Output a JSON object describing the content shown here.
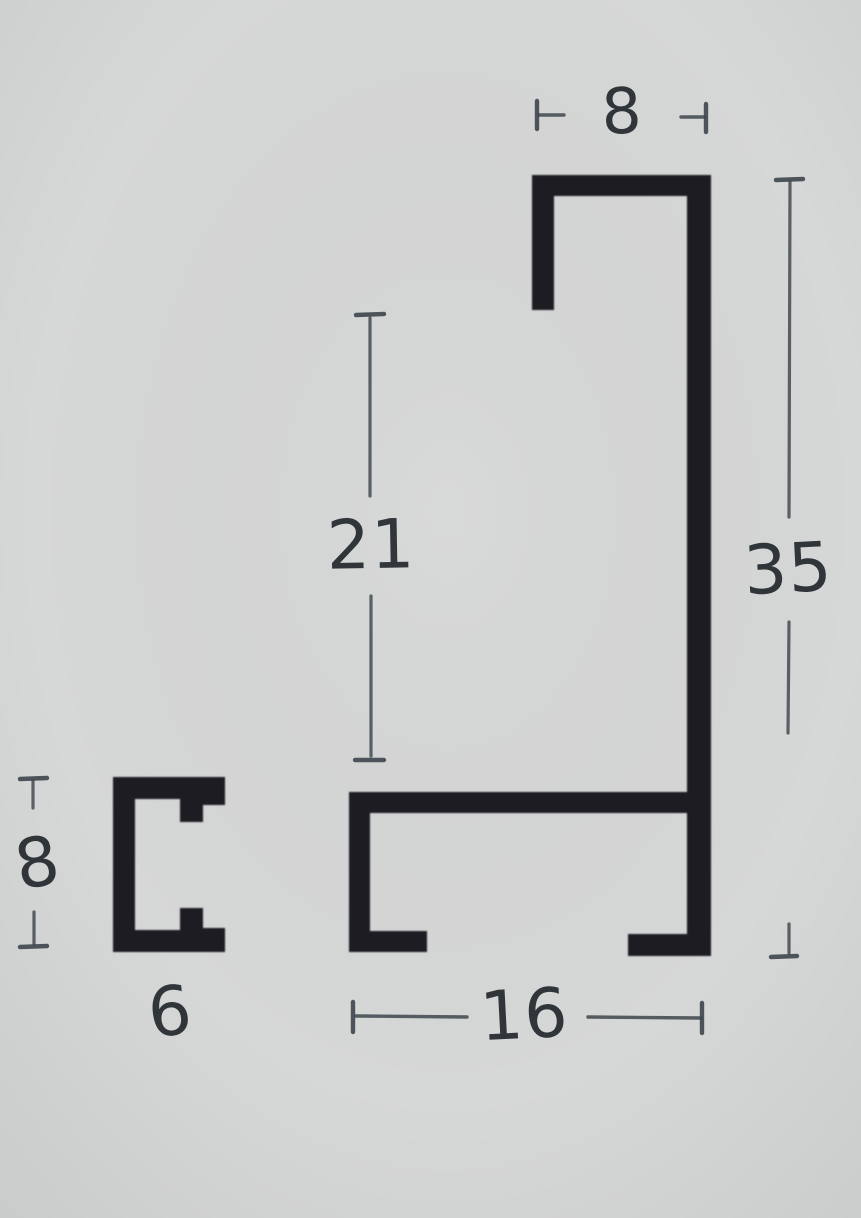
{
  "page": {
    "background": "#d6d7d7"
  },
  "palette": {
    "profile_fill": "#1e1f22",
    "dim_ink": "#3d454c",
    "label_ink": "#262c31"
  },
  "drawing": {
    "kind": "profile-cross-section-technical-drawing",
    "labels": {
      "top_width": "8",
      "upper_height": "21",
      "total_height": "35",
      "bottom_width": "16",
      "small_height": "8",
      "small_width": "6"
    }
  }
}
